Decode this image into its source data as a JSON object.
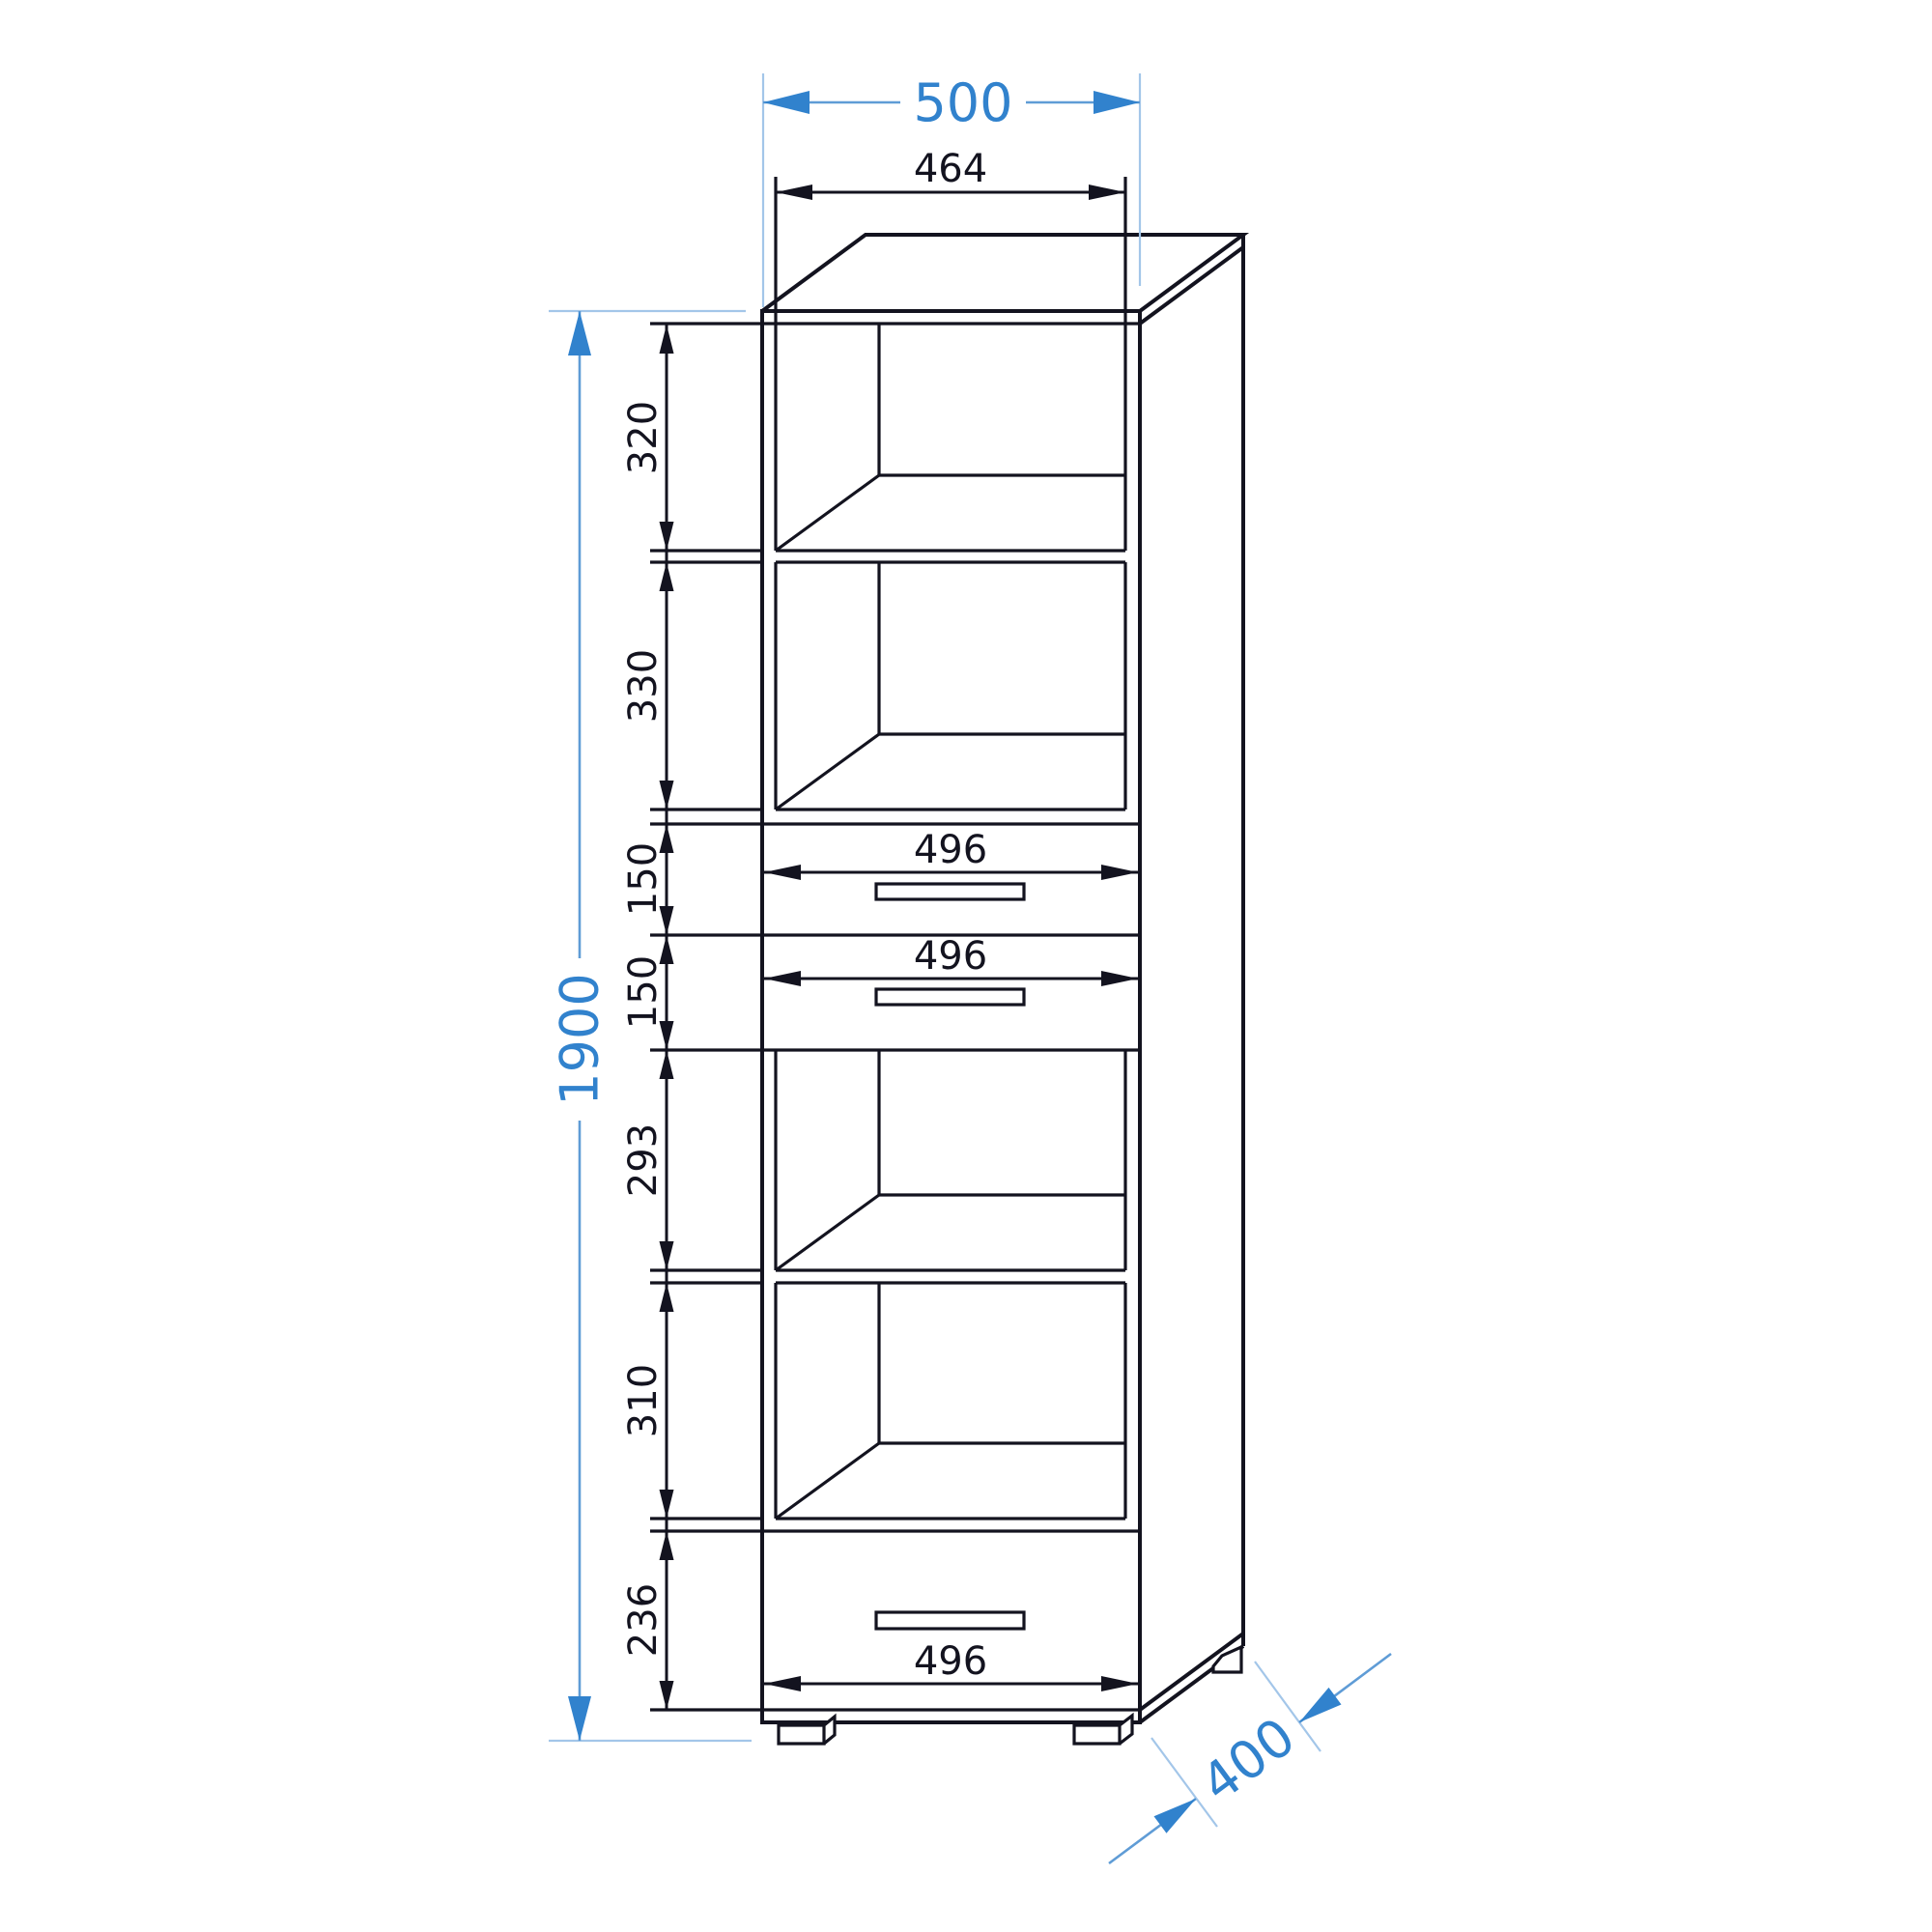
{
  "colors": {
    "ink": "#13131f",
    "blue_strong": "#3182cd",
    "blue_medium": "#5f9cd6",
    "blue_light": "#a3c6e9",
    "background": "#ffffff"
  },
  "dims": {
    "overall_width": "500",
    "inner_width": "464",
    "overall_height": "1900",
    "overall_depth": "400",
    "drawer_widths": [
      "496",
      "496",
      "496"
    ],
    "sections": [
      "320",
      "330",
      "150",
      "150",
      "293",
      "310",
      "236"
    ]
  }
}
